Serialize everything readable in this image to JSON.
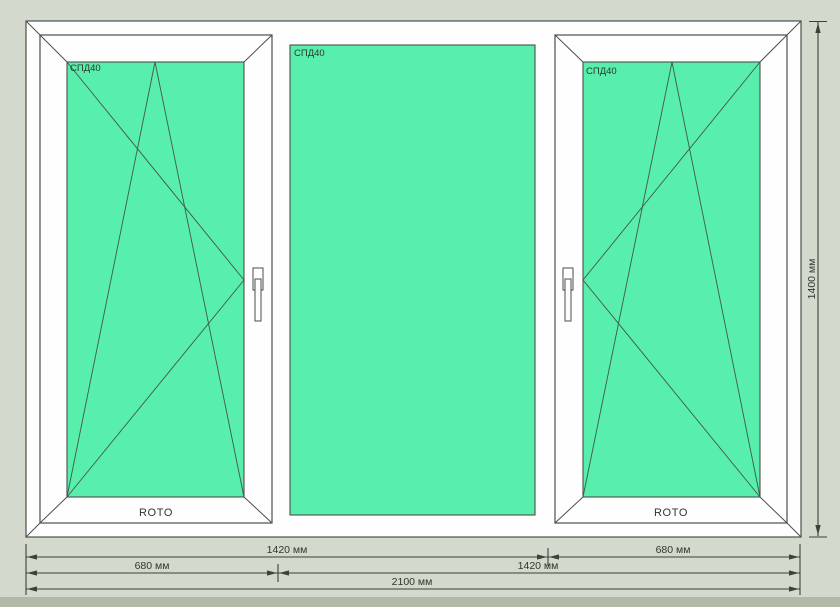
{
  "canvas": {
    "type": "window-construction-drawing"
  },
  "window": {
    "sections": [
      {
        "name": "left",
        "type": "tilt-turn-sash",
        "glass_label": "СПД40",
        "hardware_brand": "ROTO"
      },
      {
        "name": "center",
        "type": "fixed-glazing",
        "glass_label": "СПД40"
      },
      {
        "name": "right",
        "type": "tilt-turn-sash",
        "glass_label": "СПД40",
        "hardware_brand": "ROTO"
      }
    ]
  },
  "dimensions": {
    "vertical": {
      "label": "1400 мм"
    },
    "bottom_rows": [
      {
        "segments": [
          {
            "label": "1420 мм"
          },
          {
            "label": "680 мм"
          }
        ]
      },
      {
        "segments": [
          {
            "label": "680 мм"
          },
          {
            "label": "1420 мм"
          }
        ]
      },
      {
        "segments": [
          {
            "label": "2100 мм"
          }
        ]
      }
    ]
  },
  "colors": {
    "background": "#d3d9cc",
    "bottom_strip": "#b2b9a8",
    "frame": "#fefefe",
    "frame_outline": "#4a4f4a",
    "glass": "#57efab",
    "symbol_line": "#44564c",
    "dimension_line": "#39423c",
    "text": "#2e372f"
  }
}
